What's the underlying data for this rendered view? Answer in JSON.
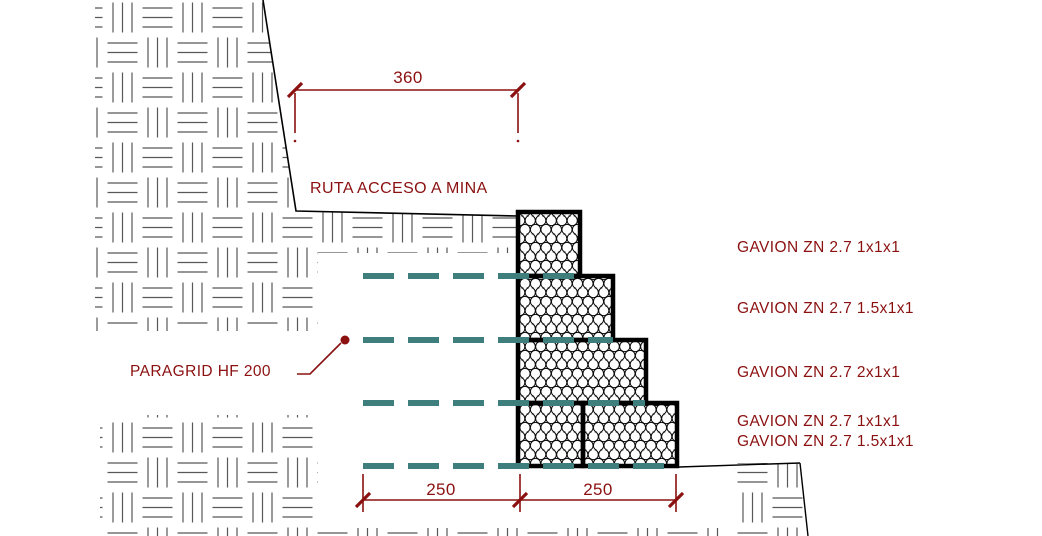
{
  "drawing": {
    "road_note": "RUTA ACCESO A MINA",
    "dimensions": {
      "top_width": "360",
      "bottom_left": "250",
      "bottom_right": "250"
    },
    "labels": {
      "paragrid": "PARAGRID HF 200",
      "gavion_rows": [
        "GAVION ZN 2.7 1x1x1",
        "GAVION ZN 2.7 1.5x1x1",
        "GAVION ZN 2.7 2x1x1",
        "GAVION ZN 2.7 1x1x1",
        "GAVION ZN 2.7 1.5x1x1"
      ]
    },
    "colors": {
      "annotation": "#8b1010",
      "geogrid": "#3e7f7e",
      "outline": "#000000",
      "hatch": "#585858"
    }
  }
}
